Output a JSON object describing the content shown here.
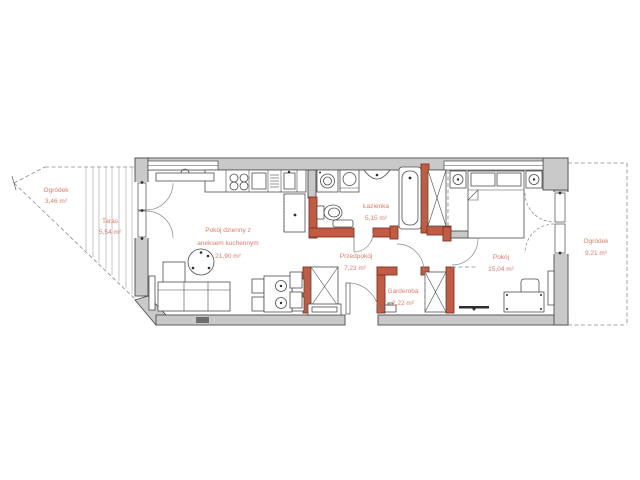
{
  "plan": {
    "rooms": {
      "garden_left": {
        "name": "Ogródek",
        "area": "3,46 m²"
      },
      "terrace": {
        "name": "Taras",
        "area": "5,54 m²"
      },
      "living": {
        "line1": "Pokój dzienny z",
        "line2": "aneksem kuchennym",
        "area": "21,90 m²"
      },
      "bathroom": {
        "name": "Łazienka",
        "area": "5,15 m²"
      },
      "hall": {
        "name": "Przedpokój",
        "area": "7,23 m²"
      },
      "closet": {
        "name": "Garderoba",
        "area": "2,22 m²"
      },
      "bedroom": {
        "name": "Pokój",
        "area": "15,04 m²"
      },
      "garden_right": {
        "name": "Ogródek",
        "area": "9,21 m²"
      }
    },
    "colors": {
      "wall_fill": "#c9c9c9",
      "wall_line": "#4d4d4d",
      "highlight_wall": "#c25b43",
      "label_text": "#d97c6e"
    }
  }
}
